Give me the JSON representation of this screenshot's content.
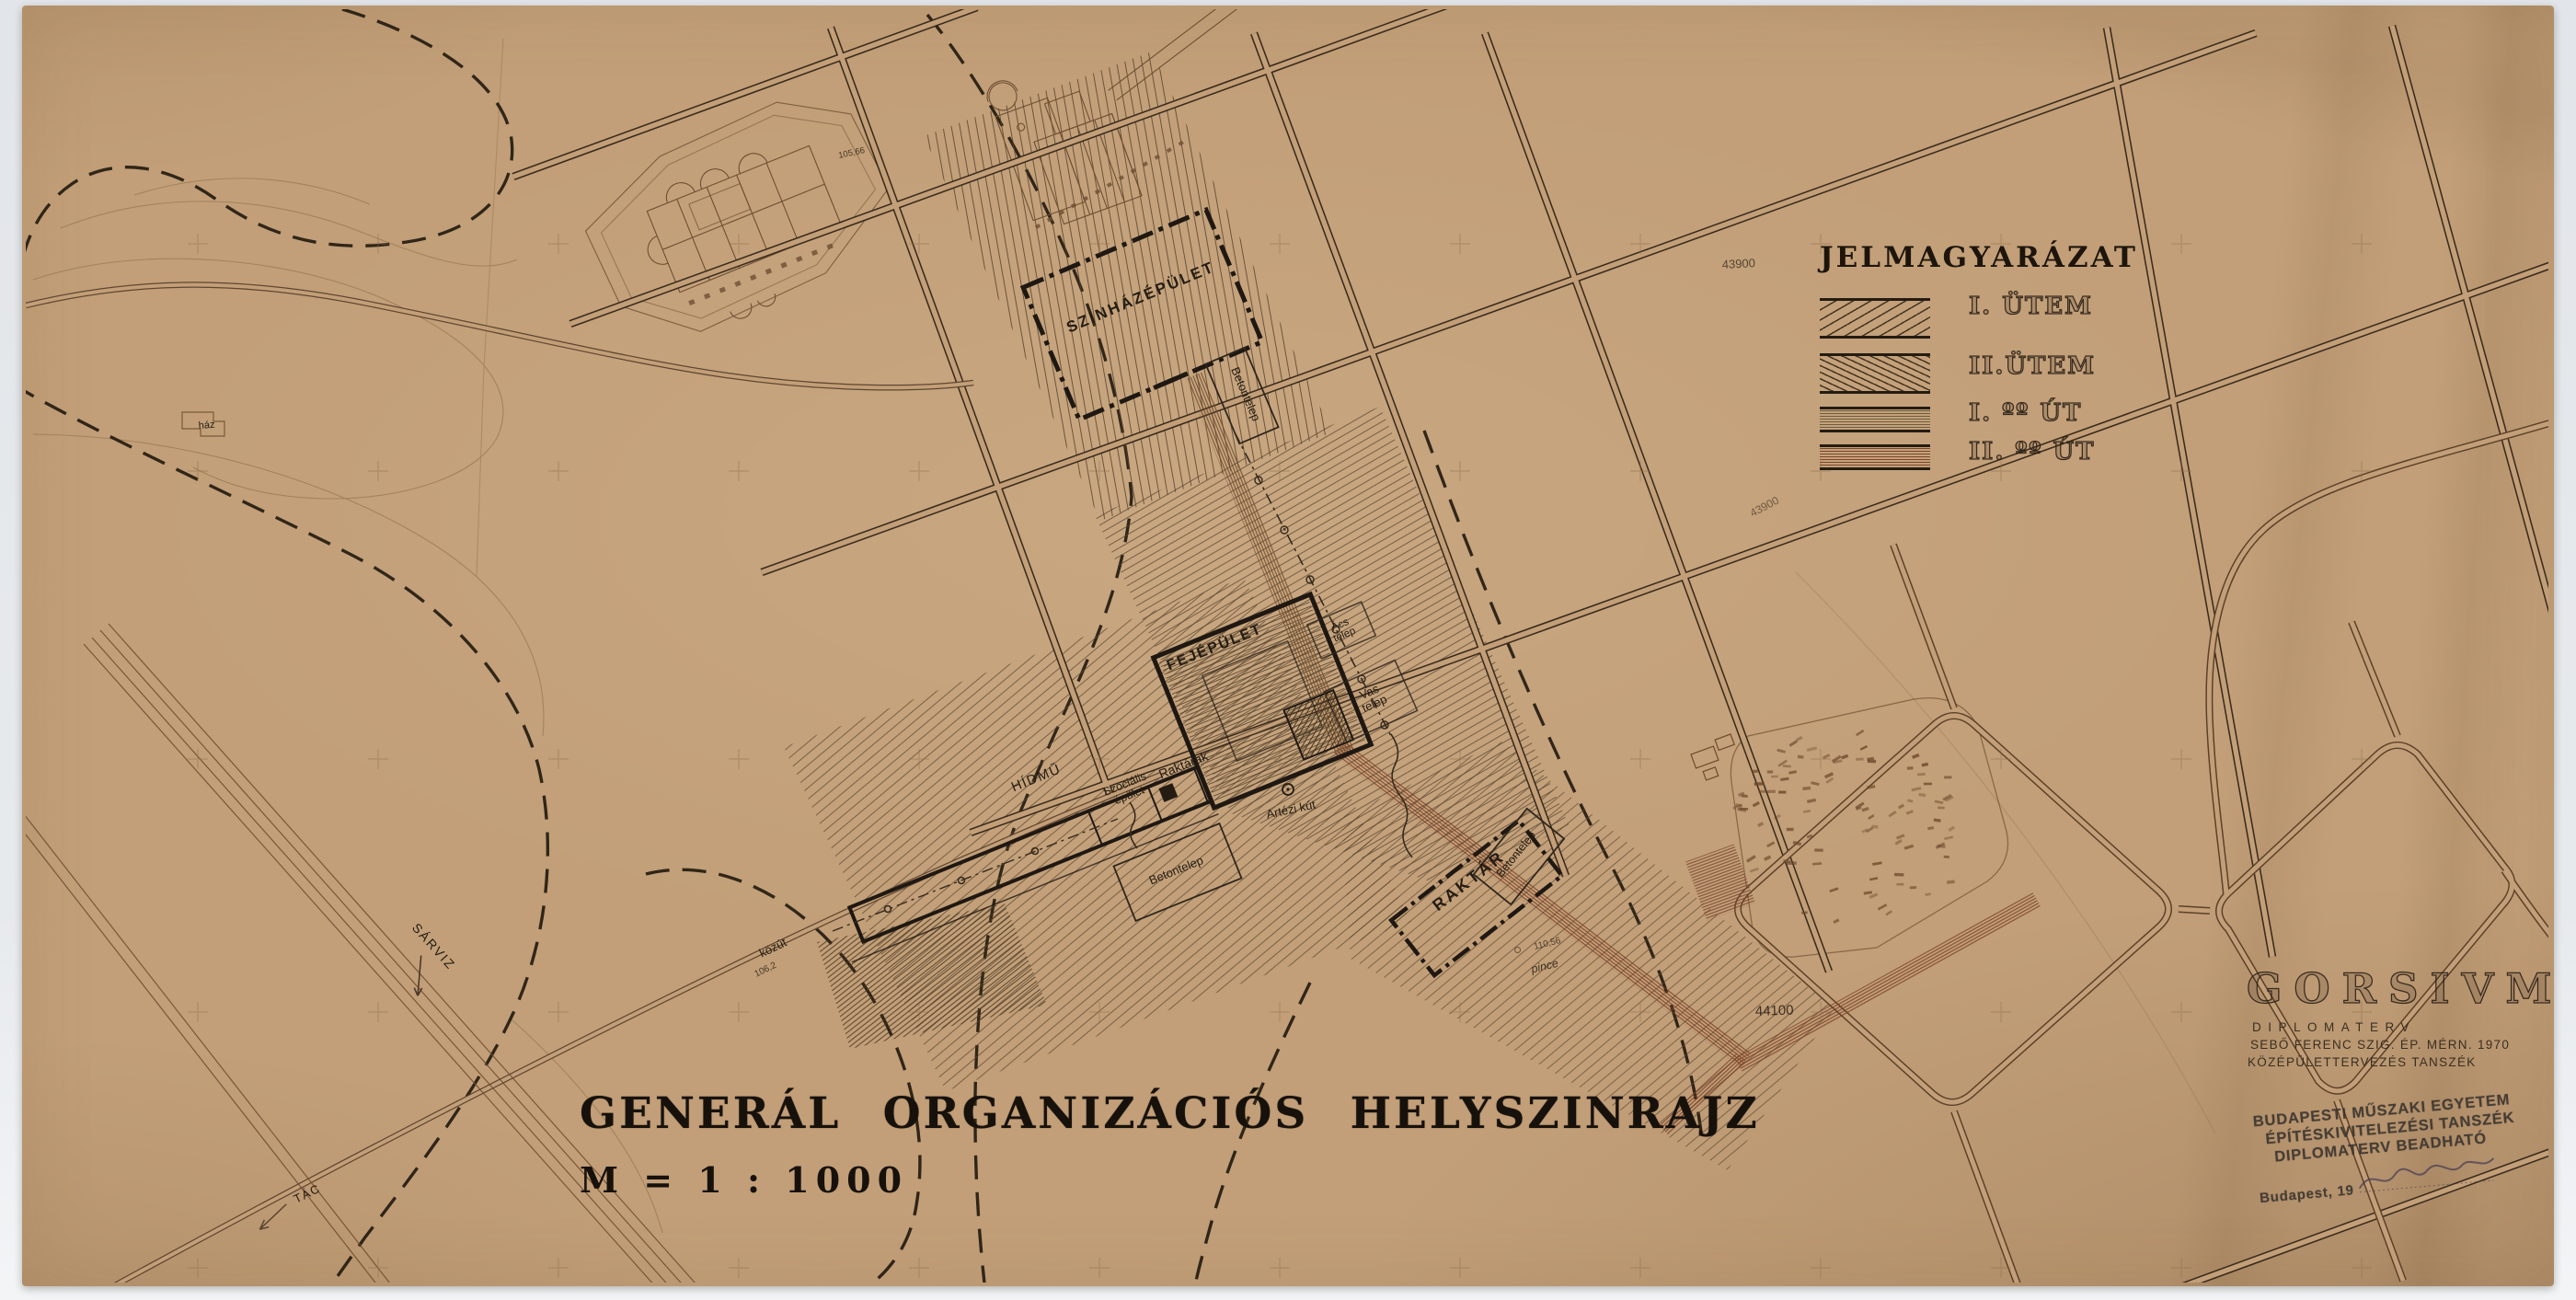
{
  "legend": {
    "title": "JELMAGYARÁZAT",
    "items": [
      {
        "label": "I. ÜTEM"
      },
      {
        "label": "II.ÜTEM"
      },
      {
        "label": "I. ºº ÚT"
      },
      {
        "label": "II. ºº ÚT"
      }
    ]
  },
  "title_block": {
    "title": "GENERÁL ORGANIZÁCIÓS HELYSZINRAJZ",
    "scale": "M = 1 : 1000"
  },
  "project_block": {
    "name": "GORSIVM",
    "type": "DIPLOMATERV",
    "author": "SEBŐ FERENC SZIG. ÉP. MÉRN. 1970",
    "department": "KÖZÉPÜLETTERVEZÉS TANSZÉK"
  },
  "stamp": {
    "line1": "BUDAPESTI MŰSZAKI EGYETEM",
    "line2": "ÉPÍTÉSKIVITELEZÉSI TANSZÉK",
    "line3": "DIPLOMATERV BEADHATÓ",
    "line4": "Budapest, 19"
  },
  "map_labels": {
    "theater": "SZINHÁZÉPÜLET",
    "main_building": "FEJÉPÜLET",
    "warehouse": "RAKTÁR",
    "warehouses": "Raktárak",
    "bridge_works": "HÍDMŰ",
    "social_1": "Szociális",
    "social_2": "épület",
    "concrete_yard": "Betontelep",
    "iron_yard_1": "Vas",
    "iron_yard_2": "telep",
    "carpenter_yard_1": "Ács",
    "carpenter_yard_2": "telep",
    "artesian_well": "Artézi kút",
    "cellar": "pince",
    "river": "SÁRVIZ",
    "village": "TÁC",
    "public_road": "közút",
    "house": "ház"
  },
  "annotations": {
    "pencil_1": "44100",
    "pencil_2": "43900",
    "elev_well": "110,56",
    "elev_road": "106,2",
    "elev_ruins": "105,66"
  }
}
